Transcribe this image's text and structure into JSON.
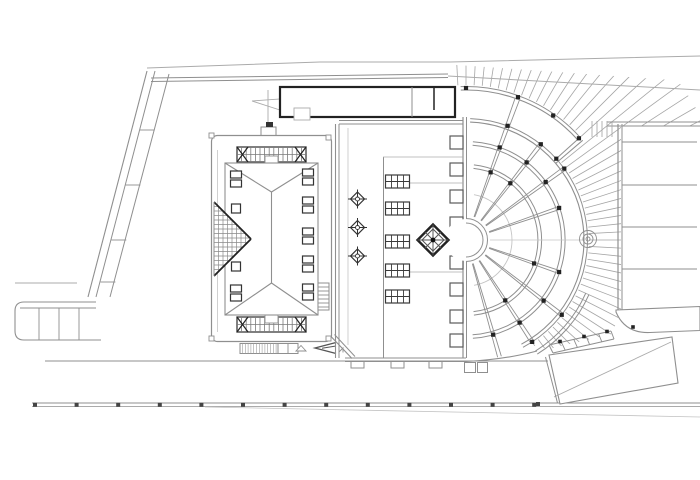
{
  "drawing": {
    "kind": "architectural-site-plan",
    "background": "#ffffff",
    "colors": {
      "faint": "#c4c4c4",
      "light": "#ababab",
      "mid": "#8f8f8f",
      "strong": "#5f5f5f",
      "dark": "#222222",
      "marker": "#444444"
    },
    "components": {
      "site_boundary": "angled site boundary with segmented retaining-wall bands",
      "main_building": "rectangular hall with hipped roof, trellis strips at both ends",
      "roof_lights_left_column": 4,
      "roof_lights_right_column": 5,
      "courtyard": "linear court with tree markers, skylight grids and diamond fountain",
      "tree_markers": 3,
      "skylight_grids": 5,
      "amphitheatre": "fan-shaped stepped terrace with radial aisles and concentric tiers",
      "radial_aisles": 9,
      "concentric_tiers": 4,
      "facade_columns": 8,
      "east_terrace_lines": 4,
      "southeast_steps": 4,
      "road_markers": 13
    }
  }
}
